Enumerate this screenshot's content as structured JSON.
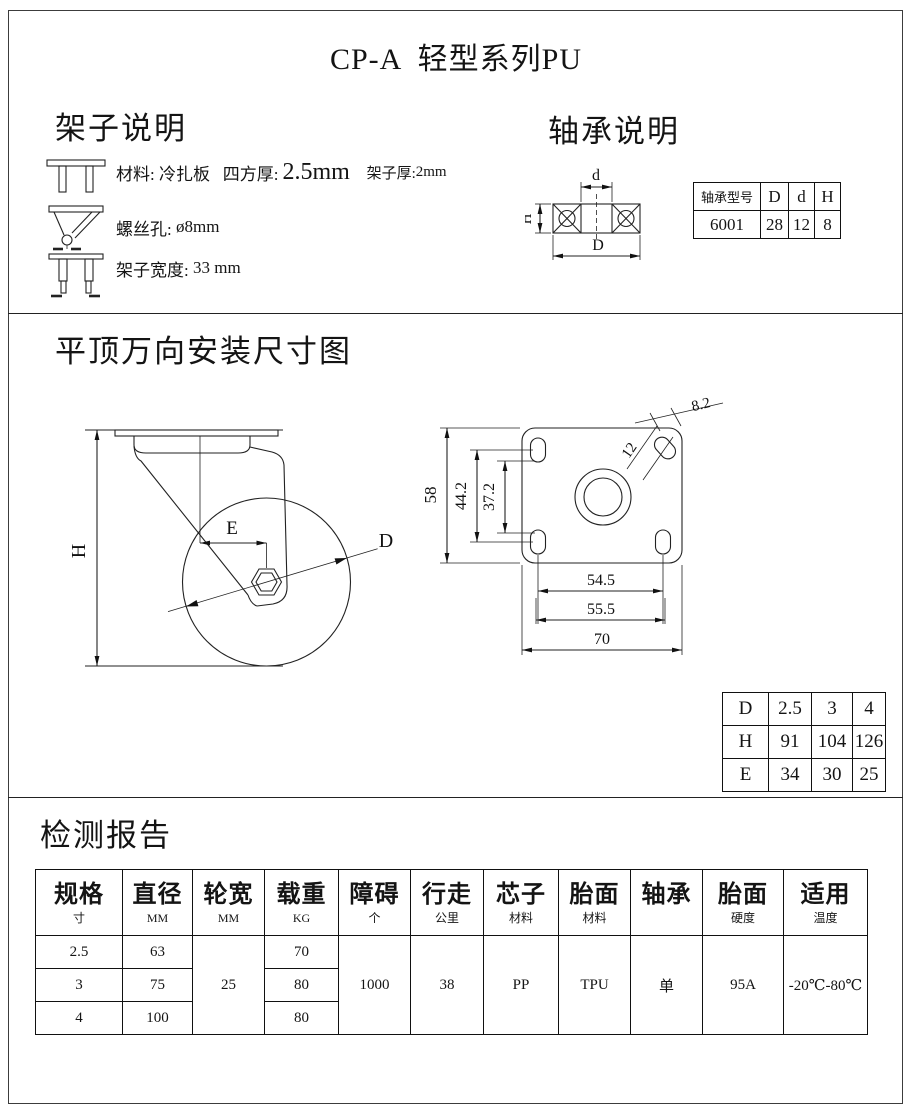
{
  "page": {
    "title": "CP-A  轻型系列PU"
  },
  "frame_section": {
    "heading": "架子说明",
    "item1": {
      "material": "材料: 冷扎板",
      "square_label": "四方厚:",
      "square_value": "2.5mm",
      "frame_label": "架子厚:",
      "frame_value": "2mm"
    },
    "item2": {
      "label": "螺丝孔:",
      "value": "ø8mm"
    },
    "item3": {
      "label": "架子宽度:",
      "value": "33 mm"
    }
  },
  "bearing_section": {
    "heading": "轴承说明",
    "labels": {
      "d": "d",
      "D": "D",
      "H": "H"
    },
    "table": {
      "type_header": "轴承型号",
      "col_D": "D",
      "col_d": "d",
      "col_H": "H",
      "model": "6001",
      "val_D": "28",
      "val_d": "12",
      "val_H": "8"
    }
  },
  "mounting_section": {
    "heading": "平顶万向安装尺寸图",
    "side_labels": {
      "h": "H",
      "e": "E",
      "d": "D"
    },
    "plate_dims": {
      "height": "58",
      "hole_span_outer": "44.2",
      "hole_span_inner": "37.2",
      "slot_width": "12",
      "slot_len": "8.2",
      "bottom_inner": "54.5",
      "bottom_mid": "55.5",
      "bottom_outer": "70"
    },
    "dhe_table": {
      "r1": [
        "D",
        "2.5",
        "3",
        "4"
      ],
      "r2": [
        "H",
        "91",
        "104",
        "126"
      ],
      "r3": [
        "E",
        "34",
        "30",
        "25"
      ]
    }
  },
  "report_section": {
    "heading": "检测报告",
    "table": {
      "h": [
        {
          "m": "规格",
          "s": "寸"
        },
        {
          "m": "直径",
          "s": "MM"
        },
        {
          "m": "轮宽",
          "s": "MM"
        },
        {
          "m": "载重",
          "s": "KG"
        },
        {
          "m": "障碍",
          "s": "个"
        },
        {
          "m": "行走",
          "s": "公里"
        },
        {
          "m": "芯子",
          "s": "材料"
        },
        {
          "m": "胎面",
          "s": "材料"
        },
        {
          "m": "轴承",
          "s": ""
        },
        {
          "m": "胎面",
          "s": "硬度"
        },
        {
          "m": "适用",
          "s": "温度"
        }
      ],
      "spec": [
        "2.5",
        "3",
        "4"
      ],
      "diameter": [
        "63",
        "75",
        "100"
      ],
      "load": [
        "70",
        "80",
        "80"
      ],
      "wheel_width": "25",
      "obstacle": "1000",
      "distance": "38",
      "core": "PP",
      "tread": "TPU",
      "bearing": "单",
      "hardness": "95A",
      "temperature": "-20℃-80℃"
    }
  }
}
